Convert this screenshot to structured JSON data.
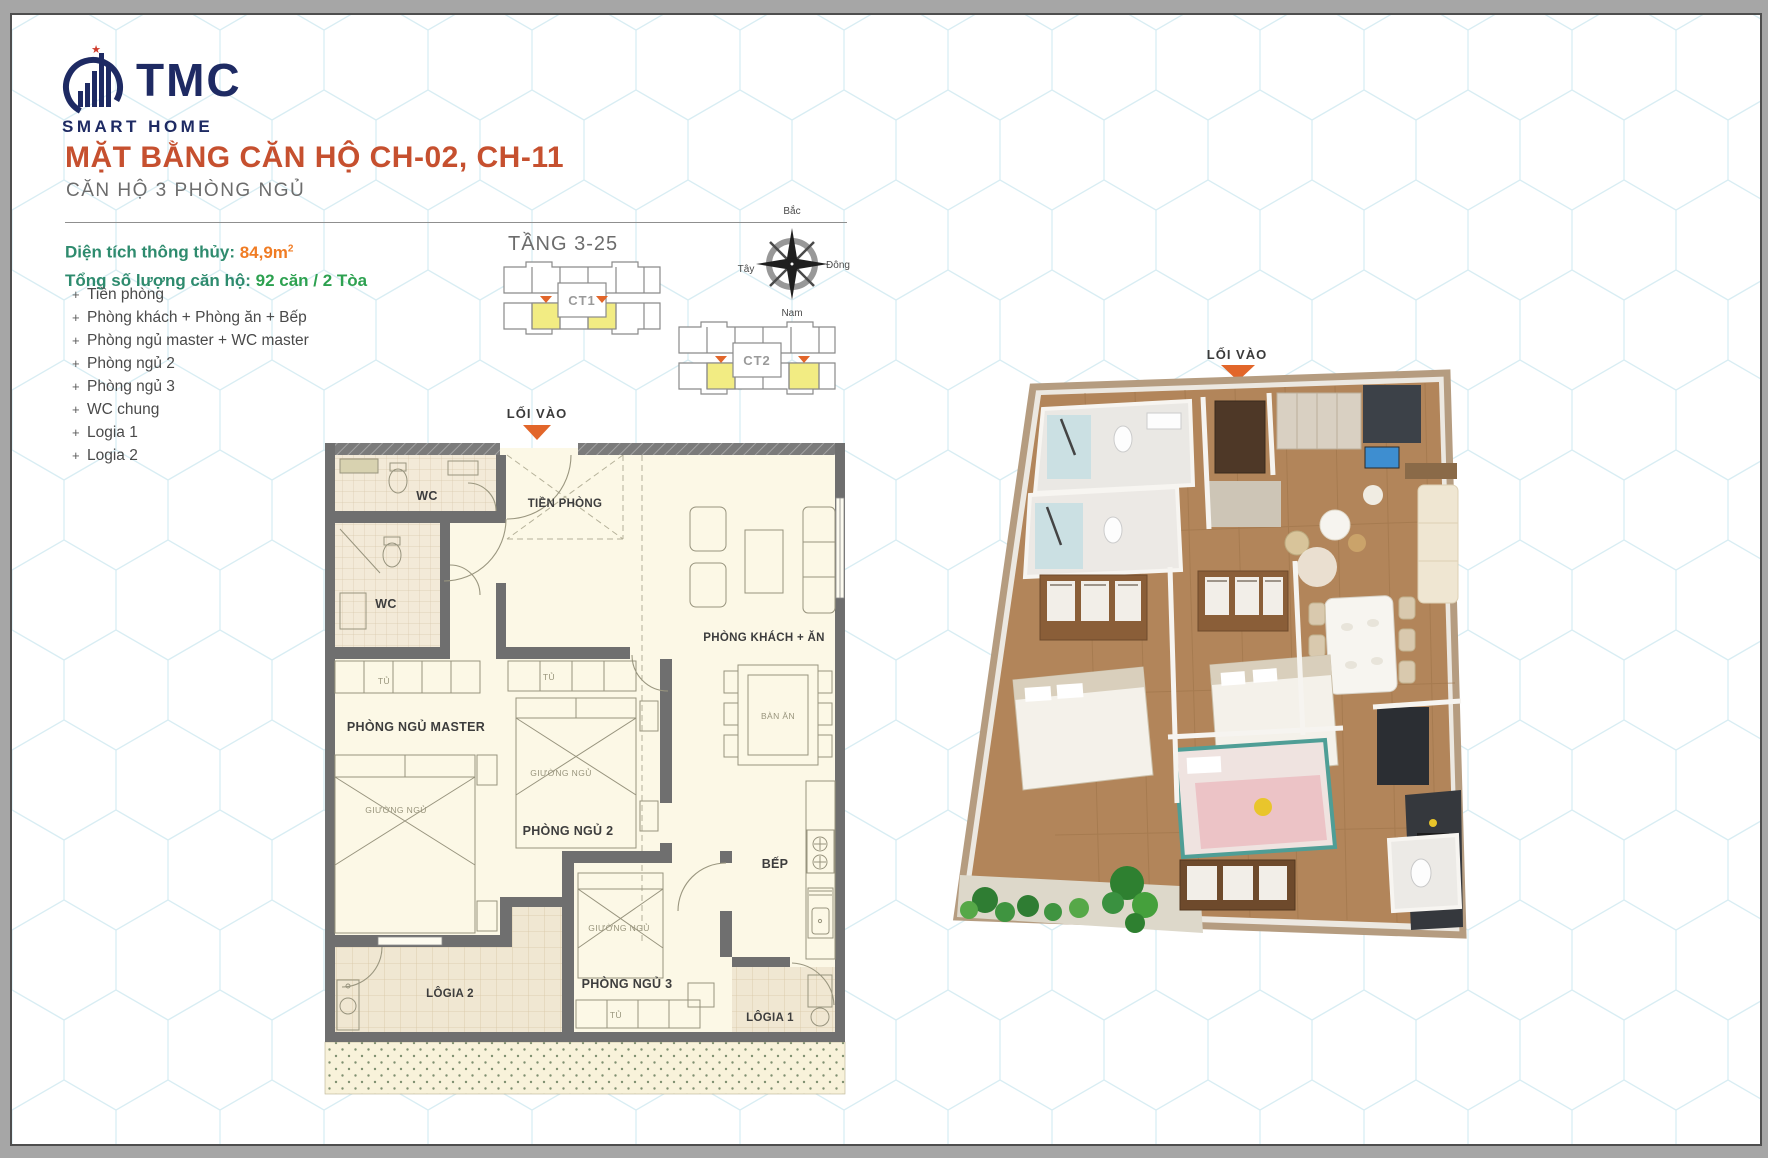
{
  "window": {
    "outer_bg": "#a6a6a6",
    "page_border": "#4e4e4e"
  },
  "brand": {
    "name": "TMC",
    "tagline": "SMART HOME"
  },
  "header": {
    "title": "MẶT BẰNG CĂN HỘ CH-02, CH-11",
    "subtitle": "CĂN HỘ 3 PHÒNG NGỦ"
  },
  "specs": {
    "area_label": "Diện tích thông thủy:",
    "area_value": "84,9m",
    "area_sup": "2",
    "units_label": "Tổng số lượng căn hộ:",
    "units_value": "92 căn / 2 Tòa"
  },
  "room_list": [
    "Tiền phòng",
    "Phòng khách + Phòng ăn + Bếp",
    "Phòng ngủ master + WC master",
    "Phòng ngủ 2",
    "Phòng ngủ 3",
    "WC chung",
    "Logia 1",
    "Logia 2"
  ],
  "key_plan": {
    "floor_label": "TẦNG 3-25",
    "tower1": "CT1",
    "tower2": "CT2"
  },
  "compass": {
    "north": "Bắc",
    "east": "Đông",
    "south": "Nam",
    "west": "Tây"
  },
  "plan2d": {
    "entry": "LỐI VÀO",
    "wc": "WC",
    "hall": "TIỀN PHÒNG",
    "living": "PHÒNG KHÁCH + ĂN",
    "master": "PHÒNG NGỦ MASTER",
    "bed2": "PHÒNG NGỦ 2",
    "bed3": "PHÒNG NGỦ 3",
    "kitchen": "BẾP",
    "dining_table": "BÀN ĂN",
    "logia1": "LÔGIA 1",
    "logia2": "LÔGIA 2",
    "wardrobe": "TỦ",
    "bed": "GIƯỜNG NGỦ"
  },
  "plan3d": {
    "entry": "LỐI VÀO"
  },
  "colors": {
    "brand_navy": "#1e2a63",
    "brand_star_red": "#cf3a2a",
    "title_orange": "#c6502f",
    "label_green": "#2e8b6e",
    "area_orange": "#f07c24",
    "units_green": "#2da150",
    "highlight_yellow": "#f2ec83",
    "arrow_orange": "#e2662a",
    "wall_gray": "#6f6f6f",
    "plan_cream": "#fcf8e6",
    "wood_brown": "#b2855a"
  }
}
